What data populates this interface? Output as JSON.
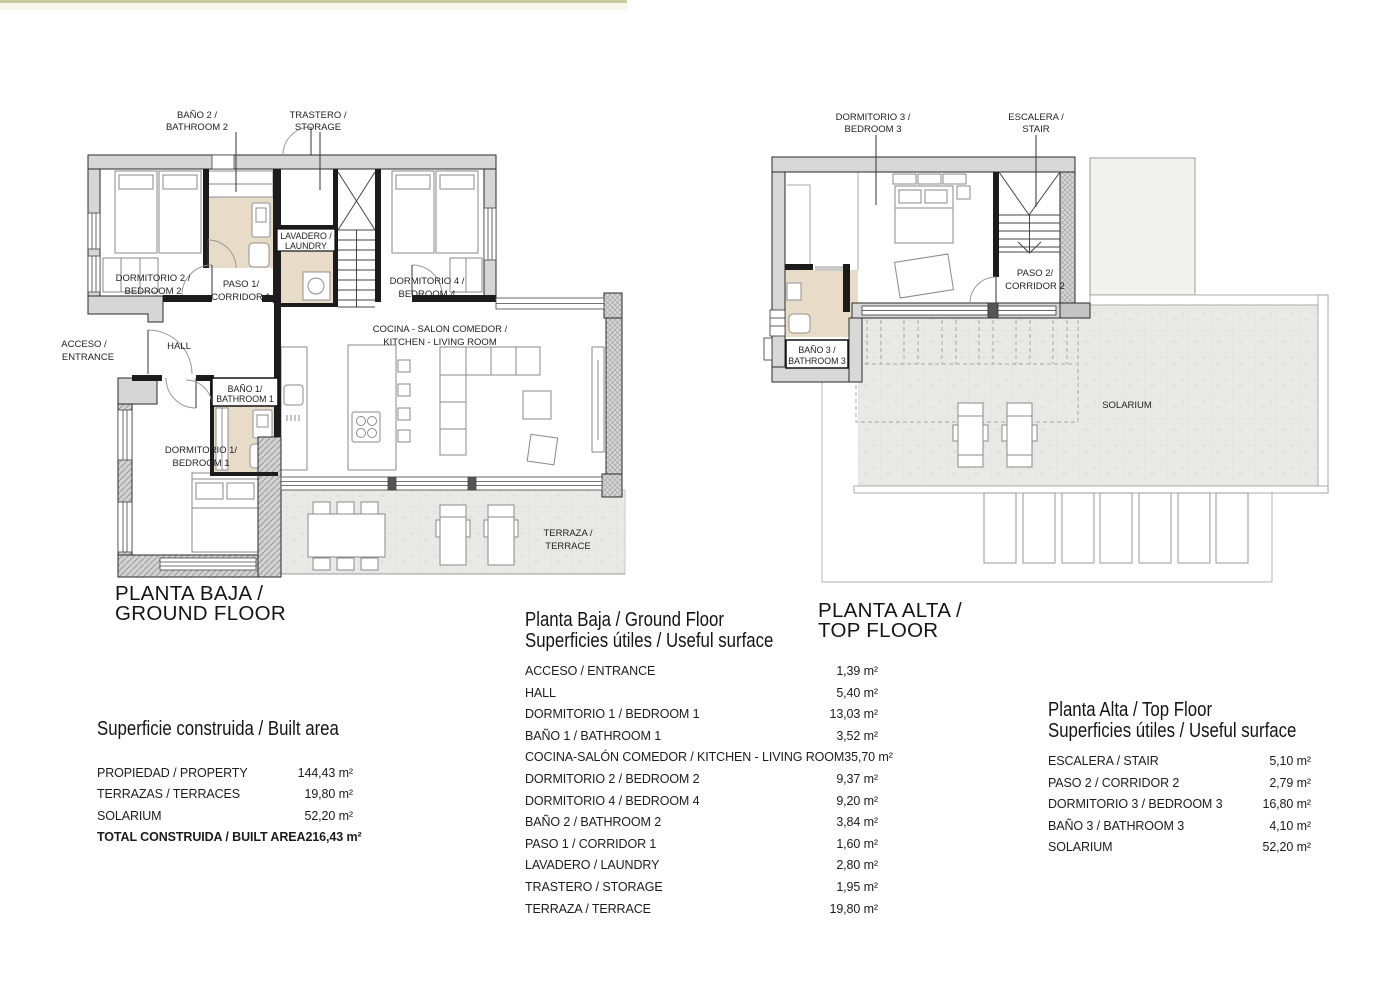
{
  "accent": {
    "olive": "#c8cb9e",
    "cream": "#f7f8ea"
  },
  "ground_plan": {
    "title": [
      "PLANTA BAJA /",
      "GROUND FLOOR"
    ],
    "labels": {
      "bath2": [
        "BAÑO 2 /",
        "BATHROOM 2"
      ],
      "storage": [
        "TRASTERO /",
        "STORAGE"
      ],
      "bedroom2": [
        "DORMITORIO 2 /",
        "BEDROOM 2"
      ],
      "corridor1": [
        "PASO 1/",
        "CORRIDOR 1"
      ],
      "laundry": [
        "LAVADERO /",
        "LAUNDRY"
      ],
      "bedroom4": [
        "DORMITORIO 4 /",
        "BEDROOM 4"
      ],
      "access": [
        "ACCESO /",
        "ENTRANCE"
      ],
      "hall": [
        "HALL"
      ],
      "bath1": [
        "BAÑO 1/",
        "BATHROOM 1"
      ],
      "kitchen": [
        "COCINA - SALON COMEDOR /",
        "KITCHEN - LIVING ROOM"
      ],
      "bedroom1": [
        "DORMITORIO 1/",
        "BEDROOM 1"
      ],
      "terrace": [
        "TERRAZA /",
        "TERRACE"
      ]
    }
  },
  "top_plan": {
    "title": [
      "PLANTA ALTA /",
      "TOP FLOOR"
    ],
    "labels": {
      "bedroom3": [
        "DORMITORIO 3 /",
        "BEDROOM 3"
      ],
      "stair": [
        "ESCALERA /",
        "STAIR"
      ],
      "corridor2": [
        "PASO 2/",
        "CORRIDOR 2"
      ],
      "bath3": [
        "BAÑO 3 /",
        "BATHROOM 3"
      ],
      "solarium": [
        "SOLARIUM"
      ]
    }
  },
  "built_area_table": {
    "title": "Superficie construida / Built area",
    "rows": [
      {
        "label": "PROPIEDAD / PROPERTY",
        "value": "144,43 m²"
      },
      {
        "label": "TERRAZAS / TERRACES",
        "value": "19,80 m²"
      },
      {
        "label": "SOLARIUM",
        "value": "52,20 m²"
      },
      {
        "label": "TOTAL CONSTRUIDA / BUILT AREA",
        "value": "216,43 m²",
        "bold": true
      }
    ]
  },
  "ground_table": {
    "title": [
      "Planta Baja / Ground Floor",
      "Superficies útiles / Useful surface"
    ],
    "rows": [
      {
        "label": "ACCESO / ENTRANCE",
        "value": "1,39 m²"
      },
      {
        "label": "HALL",
        "value": "5,40 m²"
      },
      {
        "label": "DORMITORIO 1 / BEDROOM 1",
        "value": "13,03 m²"
      },
      {
        "label": "BAÑO 1 / BATHROOM 1",
        "value": "3,52 m²"
      },
      {
        "label": "COCINA-SALÓN COMEDOR / KITCHEN - LIVING ROOM",
        "value": "35,70 m²"
      },
      {
        "label": "DORMITORIO 2 / BEDROOM 2",
        "value": "9,37 m²"
      },
      {
        "label": "DORMITORIO 4 / BEDROOM 4",
        "value": "9,20 m²"
      },
      {
        "label": "BAÑO 2 / BATHROOM 2",
        "value": "3,84 m²"
      },
      {
        "label": "PASO 1 / CORRIDOR 1",
        "value": "1,60 m²"
      },
      {
        "label": "LAVADERO / LAUNDRY",
        "value": "2,80 m²"
      },
      {
        "label": "TRASTERO / STORAGE",
        "value": "1,95 m²"
      },
      {
        "label": "TERRAZA / TERRACE",
        "value": "19,80 m²"
      }
    ]
  },
  "top_table": {
    "title": [
      "Planta Alta / Top Floor",
      "Superficies útiles / Useful surface"
    ],
    "rows": [
      {
        "label": "ESCALERA / STAIR",
        "value": "5,10 m²"
      },
      {
        "label": "PASO 2 / CORRIDOR 2",
        "value": "2,79 m²"
      },
      {
        "label": "DORMITORIO 3 / BEDROOM 3",
        "value": "16,80 m²"
      },
      {
        "label": "BAÑO 3 / BATHROOM 3",
        "value": "4,10 m²"
      },
      {
        "label": "SOLARIUM",
        "value": "52,20 m²"
      }
    ]
  }
}
